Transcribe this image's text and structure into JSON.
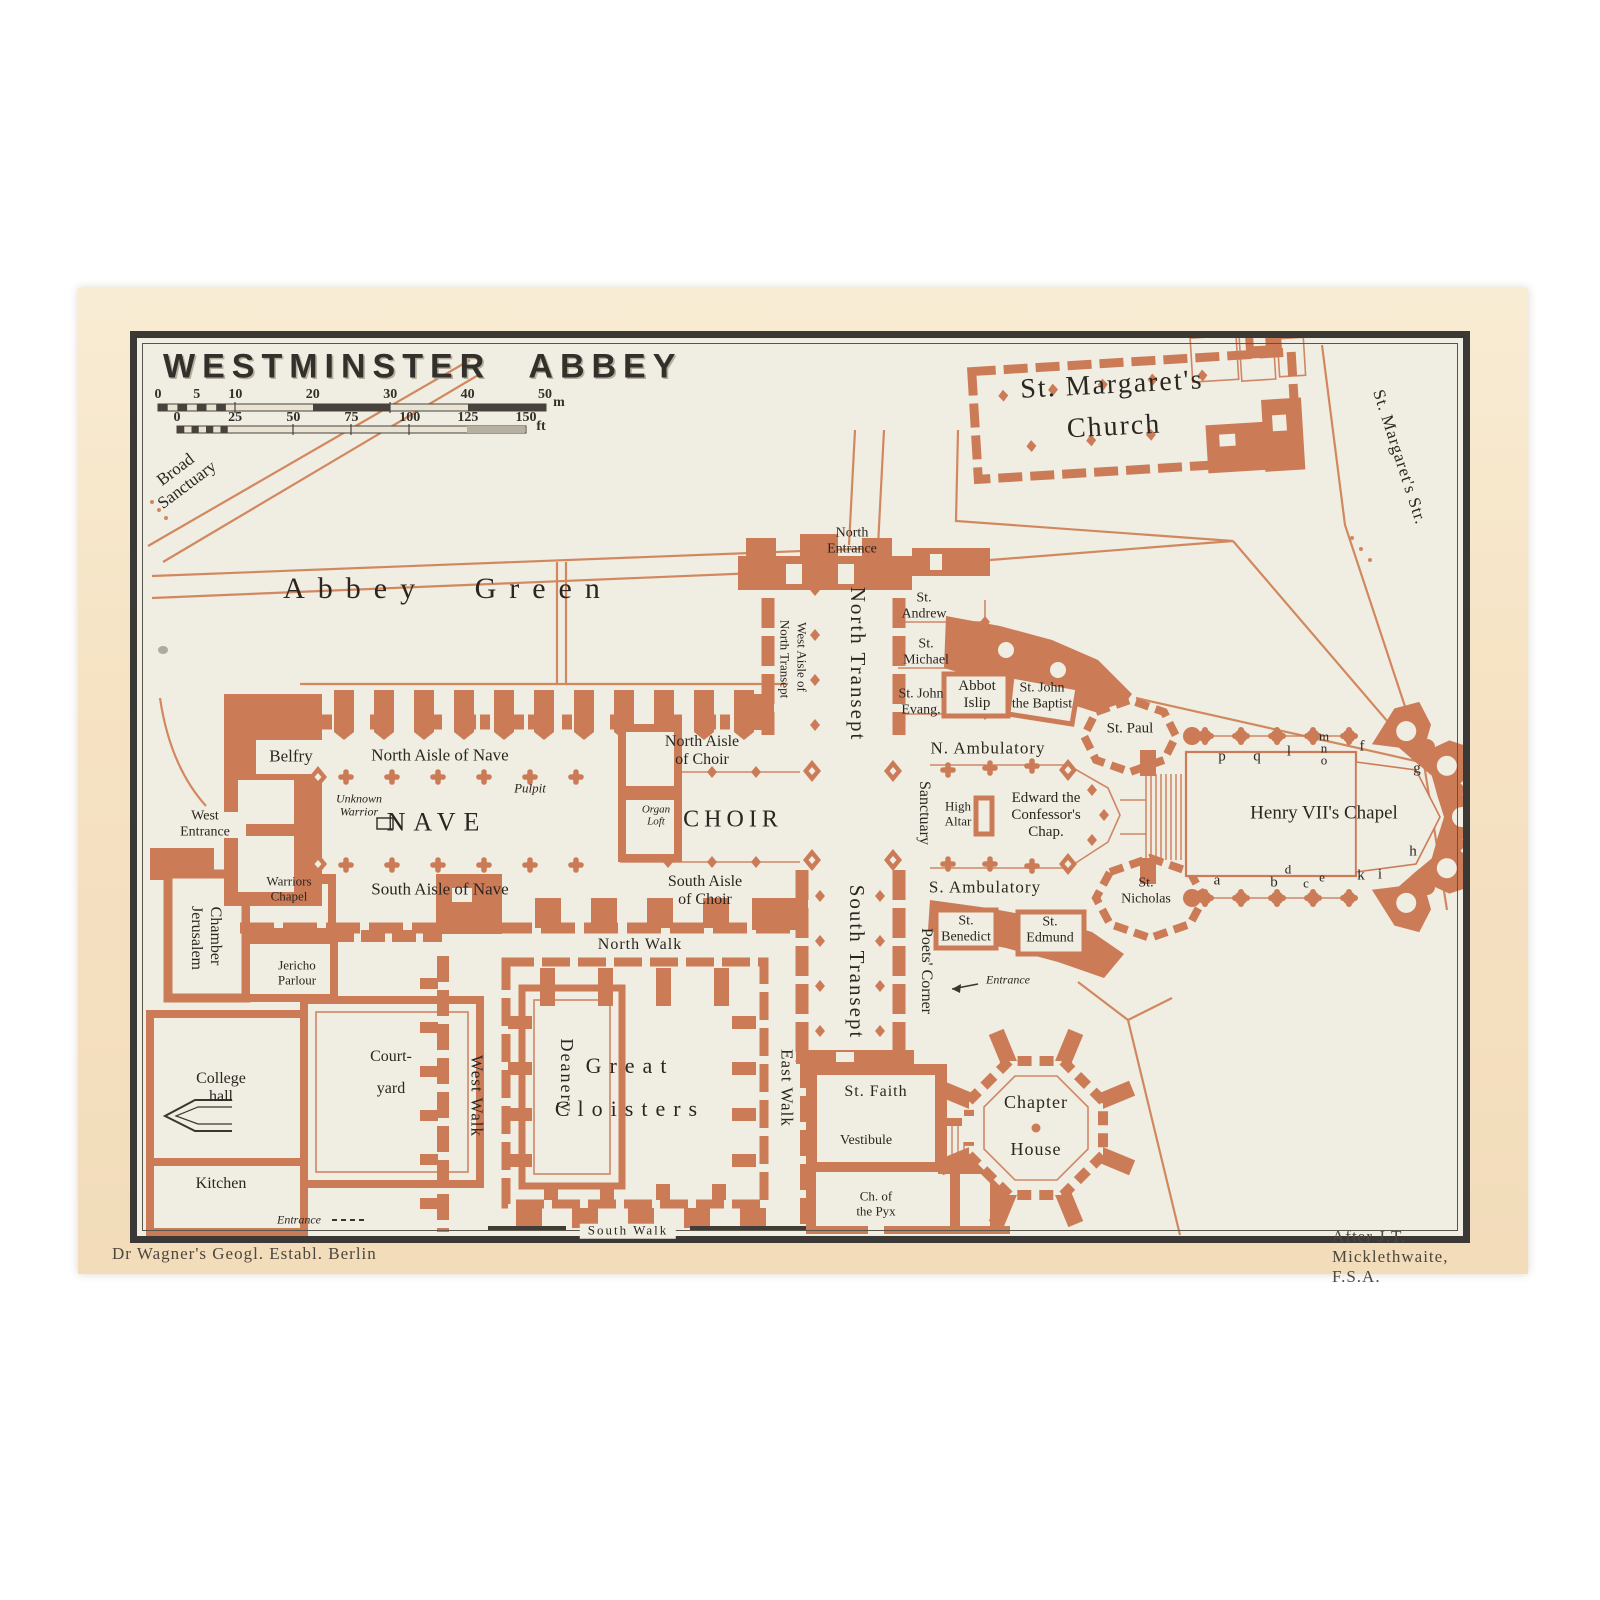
{
  "page": {
    "title": "WESTMINSTER ABBEY"
  },
  "credits": {
    "left": "Dr Wagner's Geogl. Establ. Berlin",
    "right": "After J.T. Micklethwaite, F.S.A."
  },
  "scale": {
    "meters": {
      "ticks": [
        0,
        5,
        10,
        20,
        30,
        40,
        50
      ],
      "unit": "m"
    },
    "feet": {
      "ticks": [
        0,
        25,
        50,
        75,
        100,
        125,
        150
      ],
      "unit": "ft"
    }
  },
  "colors": {
    "building": "#cc7b57",
    "street": "#d2885f",
    "map_bg": "#f0ede3",
    "paper": "#f6e3c4",
    "frame": "#3a3935",
    "text": "#2b2620"
  },
  "map_labels": [
    {
      "t": [
        "Broad",
        "Sanctuary"
      ],
      "x": 181,
      "y": 477,
      "s": 17,
      "r": -37
    },
    {
      "t": "Abbey Green",
      "x": 448,
      "y": 589,
      "s": 30,
      "ls": 13,
      "cls": "ws"
    },
    {
      "t": [
        "North",
        "Entrance"
      ],
      "x": 852,
      "y": 541,
      "s": 14
    },
    {
      "t": "North Transept",
      "x": 857,
      "y": 664,
      "s": 21,
      "r": 90,
      "ls": 2
    },
    {
      "t": "West Aisle of",
      "x": 801,
      "y": 657,
      "s": 13,
      "r": 90
    },
    {
      "t": "North Transept",
      "x": 784,
      "y": 659,
      "s": 13,
      "r": 90
    },
    {
      "t": [
        "St.",
        "Andrew"
      ],
      "x": 924,
      "y": 606,
      "s": 14
    },
    {
      "t": [
        "St.",
        "Michael"
      ],
      "x": 926,
      "y": 652,
      "s": 14
    },
    {
      "t": [
        "St. John",
        "Evang."
      ],
      "x": 921,
      "y": 702,
      "s": 14
    },
    {
      "t": [
        "Abbot",
        "Islip"
      ],
      "x": 977,
      "y": 695,
      "s": 15
    },
    {
      "t": [
        "St. John",
        "the Baptist"
      ],
      "x": 1042,
      "y": 696,
      "s": 14
    },
    {
      "t": "St. Paul",
      "x": 1130,
      "y": 729,
      "s": 15
    },
    {
      "t": "N. Ambulatory",
      "x": 988,
      "y": 748,
      "s": 17,
      "ls": 1
    },
    {
      "t": "Sanctuary",
      "x": 924,
      "y": 813,
      "s": 16,
      "r": 90
    },
    {
      "t": [
        "High",
        "Altar"
      ],
      "x": 958,
      "y": 814,
      "s": 13
    },
    {
      "t": [
        "Edward the",
        "Confessor's",
        "Chap."
      ],
      "x": 1046,
      "y": 815,
      "s": 15
    },
    {
      "t": "Henry VII's Chapel",
      "x": 1324,
      "y": 813,
      "s": 19
    },
    {
      "t": "p",
      "x": 1222,
      "y": 757,
      "s": 15
    },
    {
      "t": "q",
      "x": 1257,
      "y": 757,
      "s": 15
    },
    {
      "t": "l",
      "x": 1289,
      "y": 752,
      "s": 15
    },
    {
      "t": "m",
      "x": 1324,
      "y": 737,
      "s": 13
    },
    {
      "t": "n",
      "x": 1324,
      "y": 749,
      "s": 13
    },
    {
      "t": "o",
      "x": 1324,
      "y": 761,
      "s": 13
    },
    {
      "t": "f",
      "x": 1362,
      "y": 747,
      "s": 15
    },
    {
      "t": "g",
      "x": 1417,
      "y": 769,
      "s": 15
    },
    {
      "t": "h",
      "x": 1413,
      "y": 852,
      "s": 15
    },
    {
      "t": "a",
      "x": 1217,
      "y": 881,
      "s": 15
    },
    {
      "t": "b",
      "x": 1274,
      "y": 883,
      "s": 15
    },
    {
      "t": "d",
      "x": 1288,
      "y": 870,
      "s": 13
    },
    {
      "t": "c",
      "x": 1306,
      "y": 884,
      "s": 13
    },
    {
      "t": "e",
      "x": 1322,
      "y": 878,
      "s": 13
    },
    {
      "t": "k",
      "x": 1361,
      "y": 876,
      "s": 15
    },
    {
      "t": "i",
      "x": 1380,
      "y": 875,
      "s": 15
    },
    {
      "t": "S. Ambulatory",
      "x": 985,
      "y": 887,
      "s": 17,
      "ls": 1
    },
    {
      "t": [
        "St.",
        "Nicholas"
      ],
      "x": 1146,
      "y": 891,
      "s": 14
    },
    {
      "t": [
        "St.",
        "Benedict"
      ],
      "x": 966,
      "y": 929,
      "s": 14
    },
    {
      "t": [
        "St.",
        "Edmund"
      ],
      "x": 1050,
      "y": 930,
      "s": 14
    },
    {
      "t": "South Transept",
      "x": 856,
      "y": 962,
      "s": 21,
      "r": 90,
      "ls": 2
    },
    {
      "t": "Poets' Corner",
      "x": 926,
      "y": 971,
      "s": 16,
      "r": 90
    },
    {
      "t": "Entrance",
      "x": 1008,
      "y": 980,
      "s": 12,
      "i": 1
    },
    {
      "t": "Belfry",
      "x": 291,
      "y": 756,
      "s": 17
    },
    {
      "t": "North Aisle of Nave",
      "x": 440,
      "y": 755,
      "s": 17
    },
    {
      "t": "Pulpit",
      "x": 530,
      "y": 789,
      "s": 13,
      "i": 1
    },
    {
      "t": [
        "Unknown",
        "Warrior"
      ],
      "x": 359,
      "y": 806,
      "s": 12,
      "i": 1
    },
    {
      "t": "NAVE",
      "x": 437,
      "y": 822,
      "s": 26,
      "ls": 8
    },
    {
      "t": [
        "Organ",
        "Loft"
      ],
      "x": 656,
      "y": 816,
      "s": 11,
      "i": 1
    },
    {
      "t": "CHOIR",
      "x": 733,
      "y": 820,
      "s": 24,
      "ls": 5
    },
    {
      "t": [
        "North Aisle",
        "of Choir"
      ],
      "x": 702,
      "y": 751,
      "s": 16
    },
    {
      "t": [
        "South Aisle",
        "of Choir"
      ],
      "x": 705,
      "y": 891,
      "s": 16
    },
    {
      "t": "South Aisle of Nave",
      "x": 440,
      "y": 889,
      "s": 17
    },
    {
      "t": [
        "West",
        "Entrance"
      ],
      "x": 205,
      "y": 824,
      "s": 14
    },
    {
      "t": [
        "Warriors",
        "Chapel"
      ],
      "x": 289,
      "y": 889,
      "s": 13
    },
    {
      "t": "Jerusalem",
      "x": 196,
      "y": 938,
      "s": 16,
      "r": 90
    },
    {
      "t": "Chamber",
      "x": 215,
      "y": 936,
      "s": 16,
      "r": 90
    },
    {
      "t": [
        "Jericho",
        "Parlour"
      ],
      "x": 297,
      "y": 973,
      "s": 13
    },
    {
      "t": [
        "College",
        "hall"
      ],
      "x": 221,
      "y": 1088,
      "s": 16
    },
    {
      "t": [
        "Court-",
        "yard"
      ],
      "x": 391,
      "y": 1073,
      "s": 16,
      "cls": "lh2"
    },
    {
      "t": "Deanery",
      "x": 567,
      "y": 1076,
      "s": 18,
      "r": 90,
      "ls": 2
    },
    {
      "t": "Kitchen",
      "x": 221,
      "y": 1184,
      "s": 16
    },
    {
      "t": "Entrance",
      "x": 299,
      "y": 1220,
      "s": 12,
      "i": 1
    },
    {
      "t": "West Walk",
      "x": 477,
      "y": 1096,
      "s": 17,
      "r": 90,
      "ls": 1
    },
    {
      "t": "North Walk",
      "x": 640,
      "y": 945,
      "s": 16,
      "ls": 1
    },
    {
      "t": [
        "Great",
        "Cloisters"
      ],
      "x": 630,
      "y": 1088,
      "s": 22,
      "ls": 8,
      "cls": "lhg"
    },
    {
      "t": "East Walk",
      "x": 787,
      "y": 1088,
      "s": 17,
      "r": 90,
      "ls": 1
    },
    {
      "t": "South Walk",
      "x": 628,
      "y": 1231,
      "s": 13,
      "cls": "bg",
      "ls": 2
    },
    {
      "t": "St. Faith",
      "x": 876,
      "y": 1092,
      "s": 16,
      "ls": 1
    },
    {
      "t": "Vestibule",
      "x": 866,
      "y": 1141,
      "s": 14
    },
    {
      "t": [
        "Ch. of",
        "the Pyx"
      ],
      "x": 876,
      "y": 1204,
      "s": 13
    },
    {
      "t": [
        "Chapter",
        "House"
      ],
      "x": 1036,
      "y": 1126,
      "s": 18,
      "cls": "lhc",
      "ls": 1
    },
    {
      "t": [
        "St. Margaret's",
        "Church"
      ],
      "x": 1113,
      "y": 406,
      "s": 28,
      "r": -3,
      "cls": "lhm",
      "ls": 2
    },
    {
      "t": "St. Margaret's Str.",
      "x": 1400,
      "y": 457,
      "s": 17,
      "r": 72,
      "ls": 1
    }
  ]
}
